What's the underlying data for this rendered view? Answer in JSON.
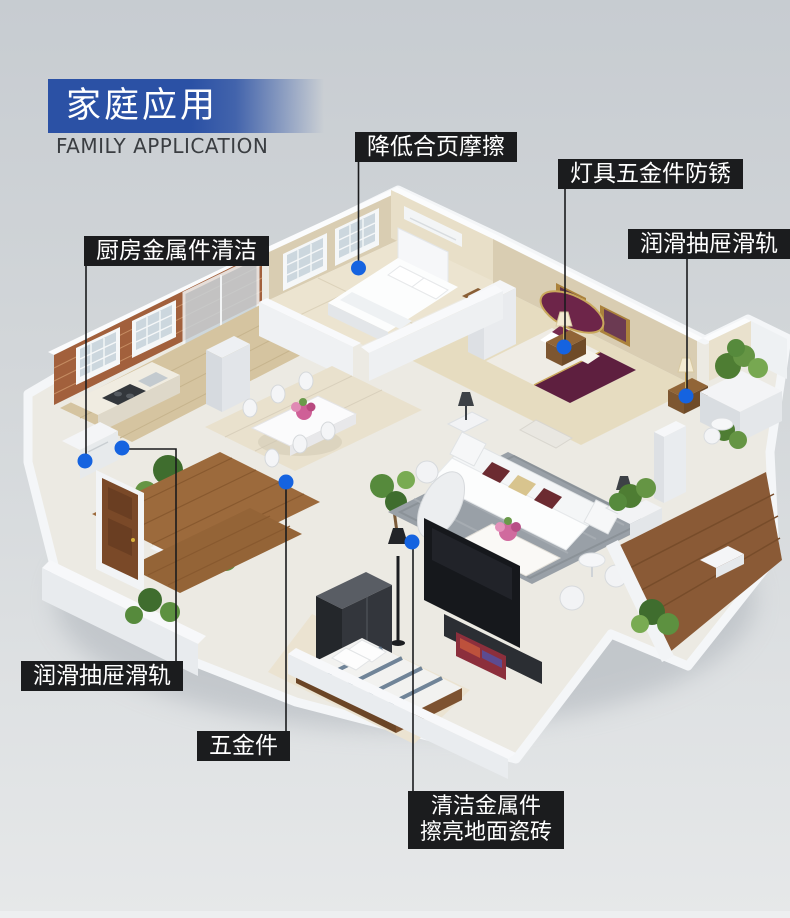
{
  "banner": {
    "title": "家庭应用",
    "subtitle": "FAMILY APPLICATION"
  },
  "colors": {
    "banner_blue": "#2b51a5",
    "label_background": "#1b1c1e",
    "label_text": "#ffffff",
    "marker_dot_blue": "#1563e0",
    "connector_line": "#1a1b1d",
    "background_top": "#c7ccd1",
    "background_bottom": "#e6e8e9"
  },
  "callouts": [
    {
      "id": "reduce-hinge-friction",
      "text": "降低合页摩擦"
    },
    {
      "id": "lamp-hardware-antirust",
      "text": "灯具五金件防锈"
    },
    {
      "id": "lubricate-drawer-rails-right",
      "text": "润滑抽屉滑轨"
    },
    {
      "id": "kitchen-metal-cleaning",
      "text": "厨房金属件清洁"
    },
    {
      "id": "lubricate-drawer-rails-left",
      "text": "润滑抽屉滑轨"
    },
    {
      "id": "hardware",
      "text": "五金件"
    },
    {
      "id": "clean-metal-polish-tiles",
      "line1": "清洁金属件",
      "line2": "擦亮地面瓷砖"
    }
  ]
}
